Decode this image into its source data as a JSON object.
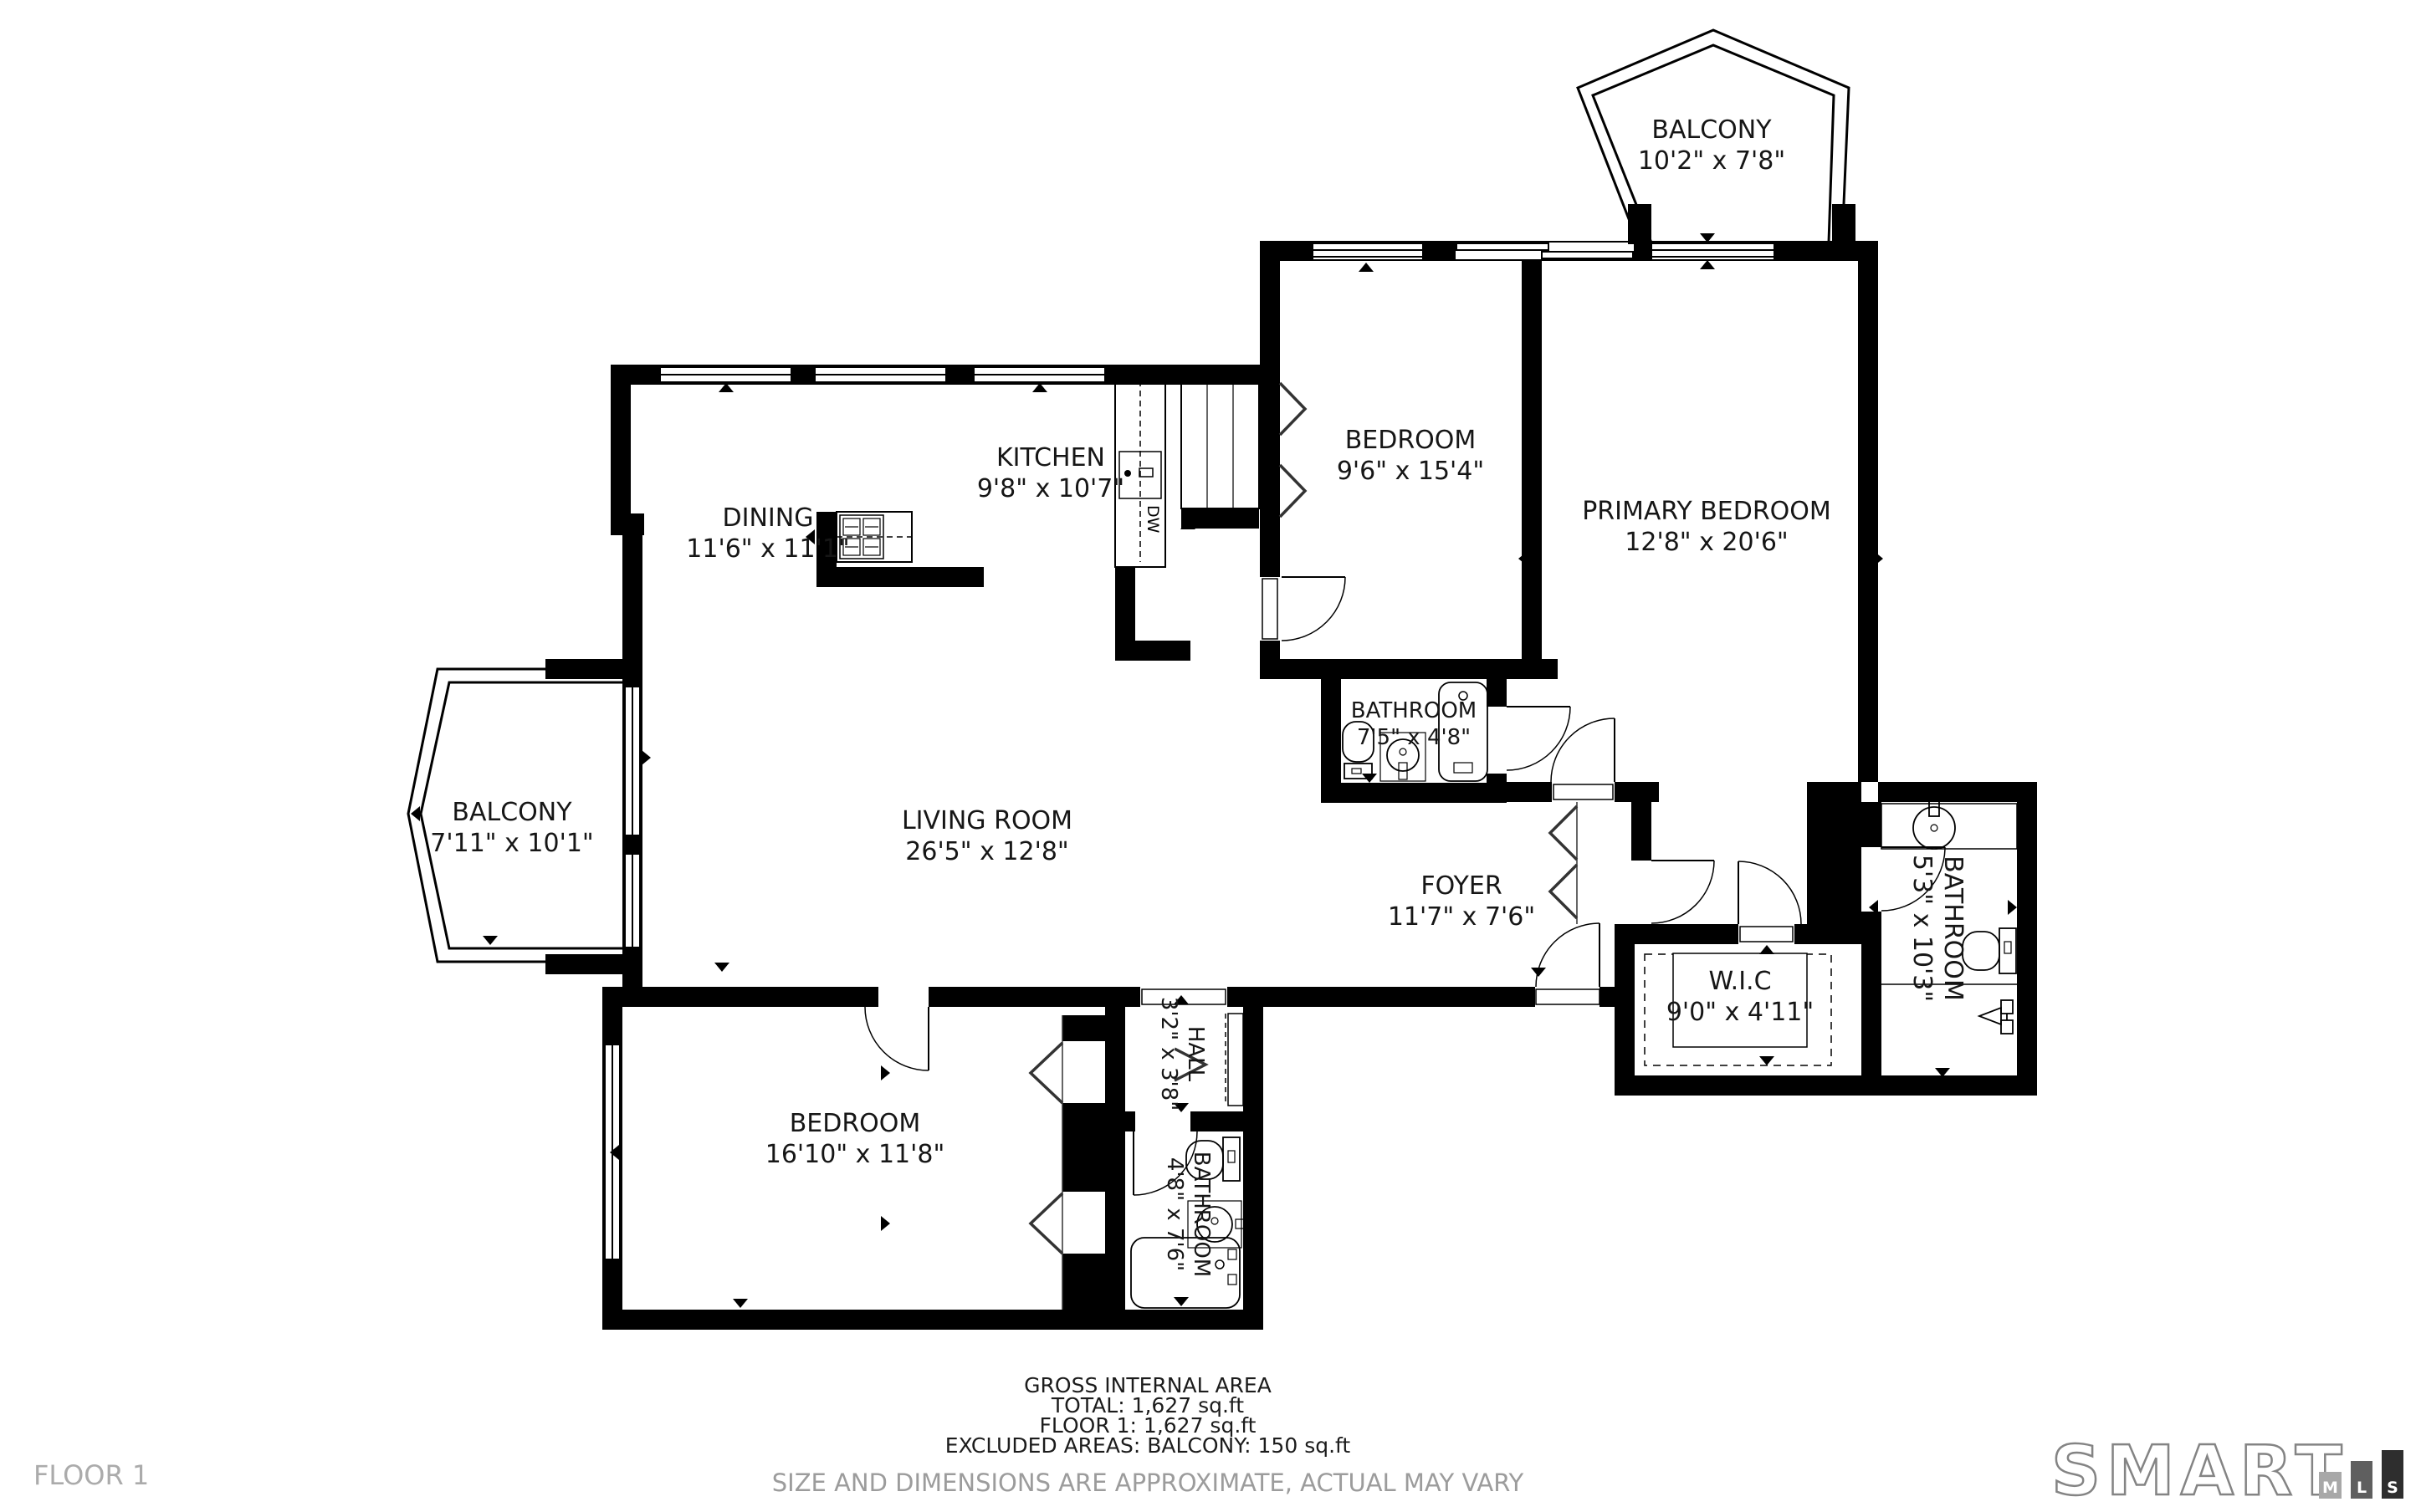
{
  "rooms": [
    {
      "id": "balcony-top",
      "name": "BALCONY",
      "dims": "10'2\" x 7'8\""
    },
    {
      "id": "bedroom-top",
      "name": "BEDROOM",
      "dims": "9'6\" x 15'4\""
    },
    {
      "id": "primary-bedroom",
      "name": "PRIMARY BEDROOM",
      "dims": "12'8\" x 20'6\""
    },
    {
      "id": "kitchen",
      "name": "KITCHEN",
      "dims": "9'8\" x 10'7\""
    },
    {
      "id": "dining",
      "name": "DINING",
      "dims": "11'6\" x 11'1\""
    },
    {
      "id": "balcony-left",
      "name": "BALCONY",
      "dims": "7'11\" x 10'1\""
    },
    {
      "id": "living-room",
      "name": "LIVING ROOM",
      "dims": "26'5\" x 12'8\""
    },
    {
      "id": "bathroom-primary",
      "name": "BATHROOM",
      "dims": "7'5\" x 4'8\""
    },
    {
      "id": "foyer",
      "name": "FOYER",
      "dims": "11'7\" x 7'6\""
    },
    {
      "id": "bathroom-ensuite",
      "name": "BATHROOM",
      "dims": "5'3\" x 10'3\""
    },
    {
      "id": "wic",
      "name": "W.I.C",
      "dims": "9'0\" x 4'11\""
    },
    {
      "id": "bedroom-bottom",
      "name": "BEDROOM",
      "dims": "16'10\" x 11'8\""
    },
    {
      "id": "hall",
      "name": "HALL",
      "dims": "3'2\" x 3'8\""
    },
    {
      "id": "bathroom-hall",
      "name": "BATHROOM",
      "dims": "4'8\" x 7'6\""
    }
  ],
  "appliances": {
    "dishwasher": "DW"
  },
  "footer": {
    "area_title": "GROSS INTERNAL AREA",
    "total": "TOTAL: 1,627 sq.ft",
    "floor1": "FLOOR 1: 1,627 sq.ft",
    "excluded": "EXCLUDED AREAS: BALCONY: 150 sq.ft",
    "disclaimer": "SIZE AND DIMENSIONS ARE APPROXIMATE, ACTUAL MAY VARY",
    "floor_label": "FLOOR 1"
  },
  "branding": {
    "logo_text": "SMART",
    "mls_letters": [
      "M",
      "L",
      "S"
    ]
  },
  "colors": {
    "walls": "#000000",
    "labels": "#161616",
    "muted": "#9c9c9c",
    "logo_gray": "#848484"
  }
}
